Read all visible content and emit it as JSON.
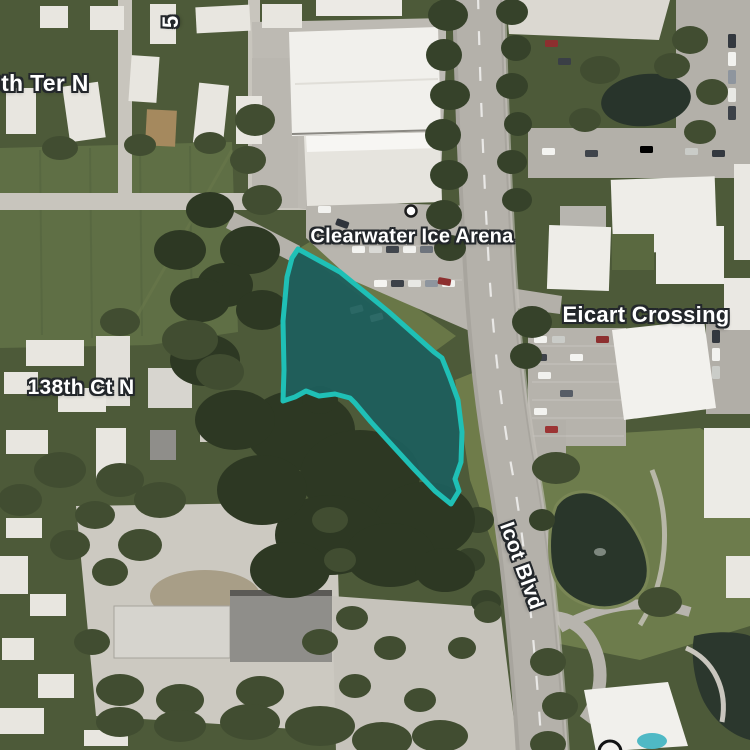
{
  "map": {
    "kind": "satellite-map",
    "labels": {
      "street_ter": "0th Ter N",
      "street_partial_vertical": "5",
      "poi_ice_arena": "Clearwater Ice Arena",
      "place_eicart": "Eicart Crossing",
      "street_138th": "138th Ct N",
      "street_icot": "Icot Blvd"
    },
    "parcel": {
      "points": "298,249 340,272 389,312 434,352 442,358 450,378 458,400 462,432 461,462 455,479 459,491 451,504 435,491 413,468 391,444 371,422 355,403 350,398 335,394 319,396 306,391 295,397 283,401 284,370 283,321 287,277 292,258",
      "fill_color": "#1d5f5c",
      "stroke_color": "#1fc0b6"
    },
    "markers": {
      "ice_arena": {
        "fill": "#ffffff",
        "ring": "#1c1c1c"
      },
      "bottom_partial": {
        "fill": "#f3f1ed",
        "ring": "#131313"
      }
    }
  }
}
